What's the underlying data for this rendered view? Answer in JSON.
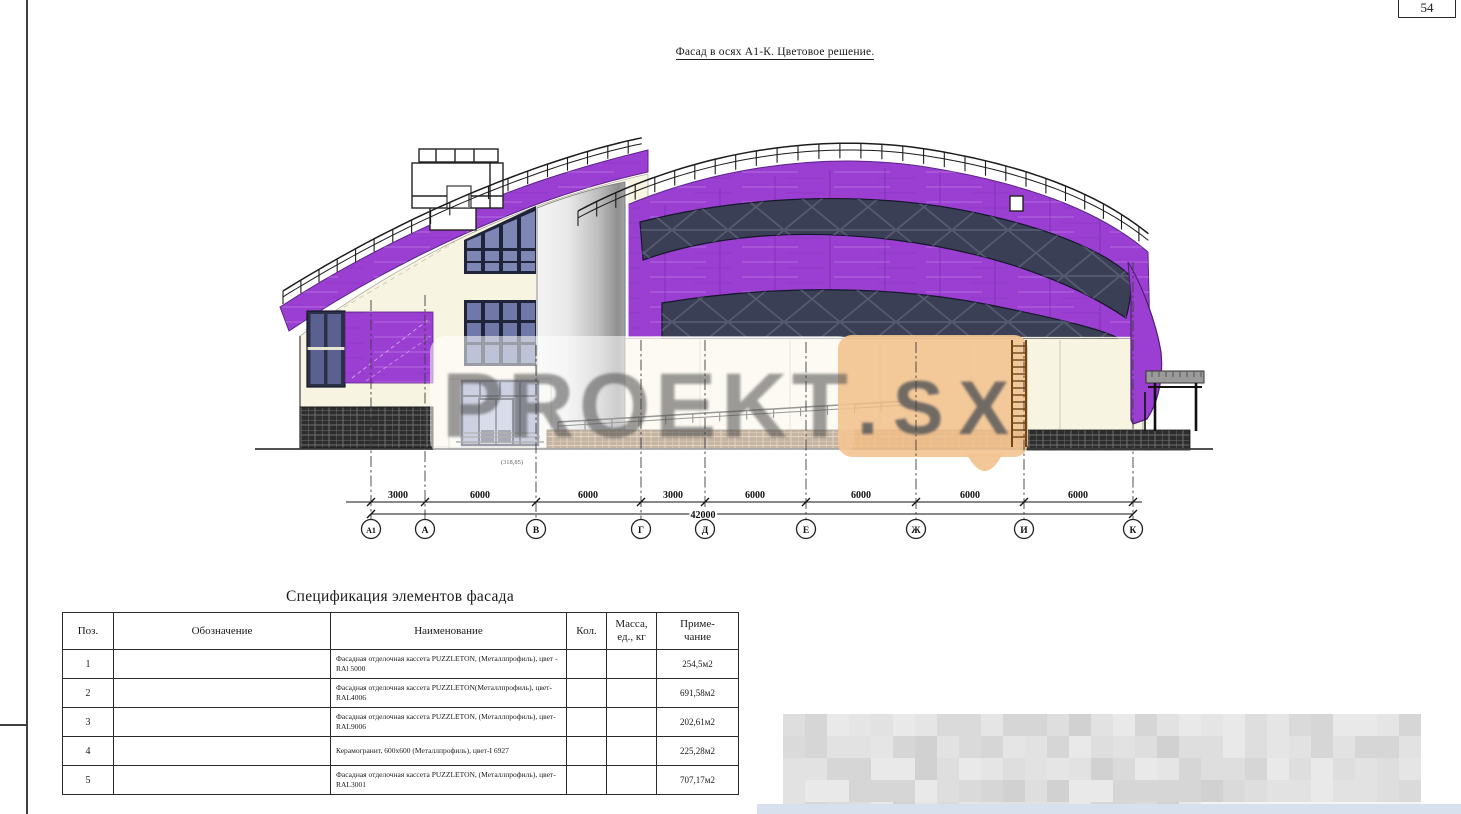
{
  "page": {
    "number": "54"
  },
  "drawing": {
    "title": "Фасад в осях А1-К. Цветовое решение.",
    "elevation_mark": "(318,85)",
    "axes": [
      "А1",
      "А",
      "В",
      "Г",
      "Д",
      "Е",
      "Ж",
      "И",
      "К"
    ],
    "dim_segments": [
      "3000",
      "6000",
      "6000",
      "3000",
      "6000",
      "6000",
      "6000",
      "6000"
    ],
    "dim_total": "42000"
  },
  "watermark": {
    "text": "PROEKT",
    "suffix": ".SX"
  },
  "spec_table": {
    "title": "Спецификация элементов фасада",
    "headers": {
      "pos": "Поз.",
      "designation": "Обозначение",
      "name": "Наименование",
      "qty": "Кол.",
      "mass": "Масса,\nед., кг",
      "note": "Приме-\nчание"
    },
    "rows": [
      {
        "pos": "1",
        "designation": "",
        "name": "Фасадная отделочная кассета PUZZLETON, (Металлпрофиль), цвет - RAl 5000",
        "qty": "",
        "mass": "",
        "note": "254,5м2"
      },
      {
        "pos": "2",
        "designation": "",
        "name": "Фасадная отделочная кассета PUZZLETON(Металлпрофиль), цвет-RAL4006",
        "qty": "",
        "mass": "",
        "note": "691,58м2"
      },
      {
        "pos": "3",
        "designation": "",
        "name": "Фасадная отделочная кассета PUZZLETON, (Металлпрофиль), цвет-RAL9006",
        "qty": "",
        "mass": "",
        "note": "202,61м2"
      },
      {
        "pos": "4",
        "designation": "",
        "name": "Керамогранит, 600х600 (Металлпрофиль), цвет-I 6927",
        "qty": "",
        "mass": "",
        "note": "225,28м2"
      },
      {
        "pos": "5",
        "designation": "",
        "name": "Фасадная отделочная кассета PUZZLETON, (Металлпрофиль), цвет-RAL3001",
        "qty": "",
        "mass": "",
        "note": "707,17м2"
      }
    ]
  },
  "colors": {
    "facade_purple": "#9b3fd2",
    "panel_navy": "#3a3f55",
    "wall_cream": "#f8f4e2",
    "watermark_orange": "#f3c493"
  }
}
